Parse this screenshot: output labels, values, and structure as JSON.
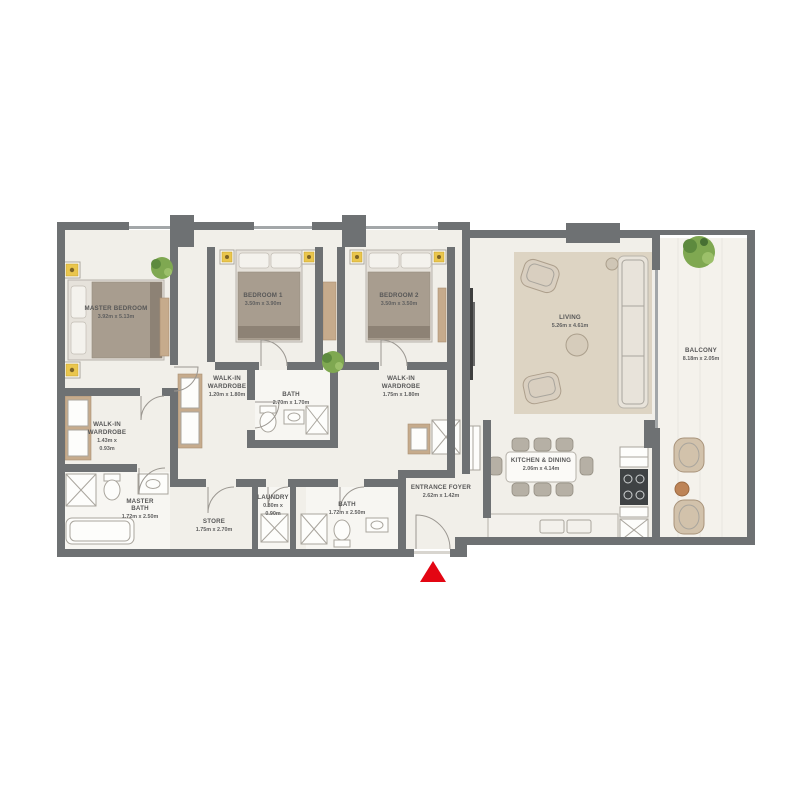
{
  "rooms": {
    "master_bedroom": {
      "name": "MASTER BEDROOM",
      "dims": "3.92m x 5.13m"
    },
    "bedroom_1": {
      "name": "BEDROOM 1",
      "dims": "3.50m x 3.90m"
    },
    "bedroom_2": {
      "name": "BEDROOM 2",
      "dims": "3.50m x 3.50m"
    },
    "living": {
      "name": "LIVING",
      "dims": "5.26m x 4.61m"
    },
    "balcony": {
      "name": "BALCONY",
      "dims": "8.18m x 2.05m"
    },
    "kitchen_dining": {
      "name": "KITCHEN & DINING",
      "dims": "2.06m x 4.14m"
    },
    "walk_in_wardrobe_1": {
      "name_line1": "WALK-IN",
      "name_line2": "WARDROBE",
      "dims": "1.20m x 1.80m"
    },
    "walk_in_wardrobe_2": {
      "name_line1": "WALK-IN",
      "name_line2": "WARDROBE",
      "dims": "1.75m x 1.80m"
    },
    "master_walk_in_wardrobe": {
      "name_line1": "WALK-IN",
      "name_line2": "WARDROBE",
      "dims_line1": "1.43m x",
      "dims_line2": "0.93m"
    },
    "bath": {
      "name": "BATH",
      "dims": "2.70m x 1.70m"
    },
    "master_bath": {
      "name_line1": "MASTER",
      "name_line2": "BATH",
      "dims": "1.72m x 2.50m"
    },
    "store": {
      "name": "STORE",
      "dims": "1.75m x 2.70m"
    },
    "laundry": {
      "name": "LAUNDRY",
      "dims_line1": "0.80m x",
      "dims_line2": "0.90m"
    },
    "bath_2": {
      "name": "BATH",
      "dims": "1.72m x 2.50m"
    },
    "entrance_foyer": {
      "name": "ENTRANCE FOYER",
      "dims": "2.62m x 1.42m"
    }
  },
  "colors": {
    "wall": "#6e7173",
    "floor": "#f1efe9",
    "wardrobe_wood": "#c6ab8c",
    "rug": "#ddd4c3",
    "entrance_marker": "#e30613",
    "plant": "#7fa851",
    "lamp": "#eac64d",
    "label_text": "#575757"
  }
}
